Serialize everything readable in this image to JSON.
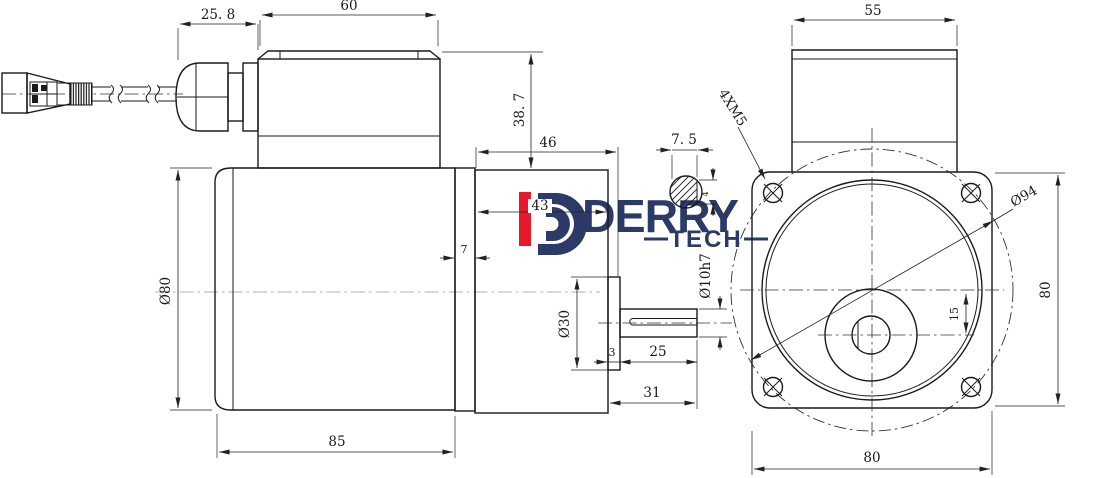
{
  "drawing": {
    "description": "Two-view engineering drawing of a small AC gear motor with cable and connector",
    "views": {
      "left": "side section view",
      "right": "front flange view"
    }
  },
  "logo": {
    "wordmark": "DERRY",
    "sub": "TECH",
    "accent_red": "#e8192d",
    "navy": "#2c3a67"
  },
  "dims": {
    "left": {
      "gland_length": "25. 8",
      "terminal_box_width": "60",
      "terminal_box_height": "38. 7",
      "gearbox_length_total": "46",
      "gearbox_length_housing": "43",
      "spacer_ring_width": "7",
      "motor_diameter": "Ø80",
      "motor_body_length": "85",
      "output_boss_diameter": "Ø30",
      "boss_protrusion": "3",
      "shaft_usable_length": "25",
      "shaft_total_length": "31",
      "shaft_diameter": "Ø10h7",
      "shaft_flat_width": "7. 5",
      "shaft_flat_chord": "4"
    },
    "front": {
      "terminal_box_width": "55",
      "mounting_holes": "4XM5",
      "bolt_circle_diameter": "Ø94",
      "flange_height": "80",
      "flange_width": "80",
      "shaft_offset": "15"
    }
  }
}
